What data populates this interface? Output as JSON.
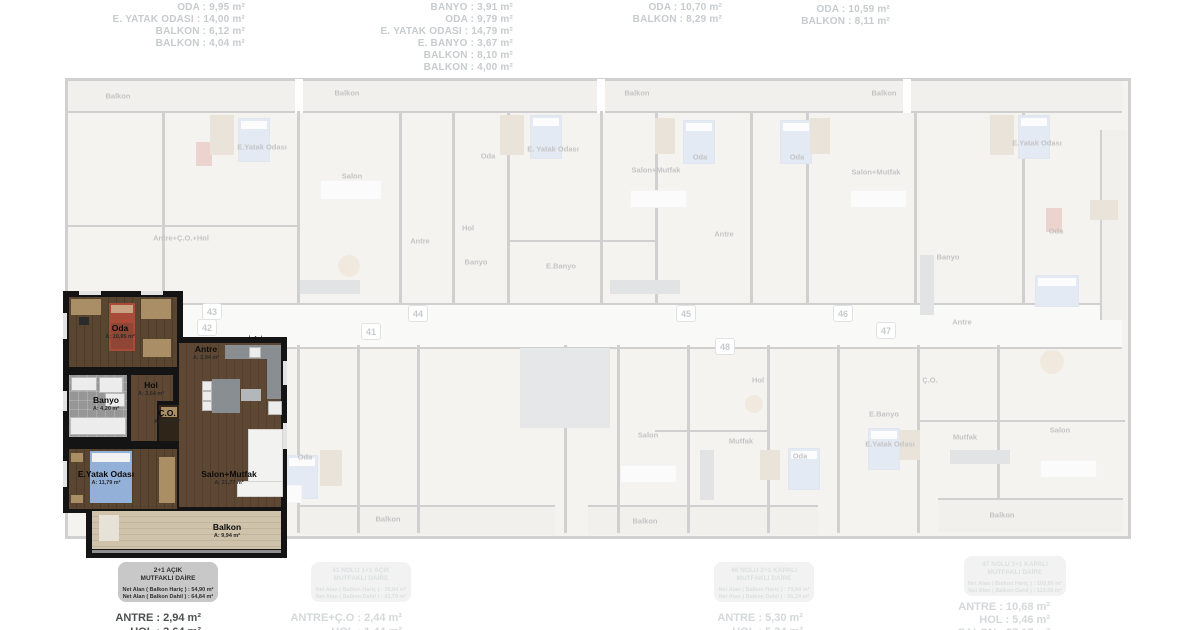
{
  "colors": {
    "highlight_wall": "#141414",
    "faded_gray": "#d1d1d1",
    "label_gray": "#c7cbce",
    "box_gray": "#c8c8c8"
  },
  "top_lines": [
    {
      "text": "ODA : 9,95 m²",
      "x": -5,
      "y": 2
    },
    {
      "text": "E. YATAK ODASI : 14,00 m²",
      "x": -5,
      "y": 14
    },
    {
      "text": "BALKON : 6,12 m²",
      "x": -5,
      "y": 26
    },
    {
      "text": "BALKON : 4,04 m²",
      "x": -5,
      "y": 38
    },
    {
      "text": "BANYO : 3,91 m²",
      "x": 263,
      "y": 2
    },
    {
      "text": "ODA : 9,79 m²",
      "x": 263,
      "y": 14
    },
    {
      "text": "E. YATAK ODASI : 14,79 m²",
      "x": 263,
      "y": 26
    },
    {
      "text": "E. BANYO : 3,67 m²",
      "x": 263,
      "y": 38
    },
    {
      "text": "BALKON : 8,10 m²",
      "x": 263,
      "y": 50
    },
    {
      "text": "BALKON : 4,00 m²",
      "x": 263,
      "y": 62
    },
    {
      "text": "ODA : 10,70 m²",
      "x": 472,
      "y": 2
    },
    {
      "text": "BALKON : 8,29 m²",
      "x": 472,
      "y": 14
    },
    {
      "text": "ODA : 10,59 m²",
      "x": 640,
      "y": 4
    },
    {
      "text": "BALKON : 8,11 m²",
      "x": 640,
      "y": 16
    }
  ],
  "plates": [
    {
      "num": "43",
      "x": 202,
      "y": 303
    },
    {
      "num": "42",
      "x": 197,
      "y": 319
    },
    {
      "num": "44",
      "x": 408,
      "y": 305
    },
    {
      "num": "41",
      "x": 361,
      "y": 323
    },
    {
      "num": "45",
      "x": 676,
      "y": 305
    },
    {
      "num": "46",
      "x": 833,
      "y": 305
    },
    {
      "num": "48",
      "x": 715,
      "y": 338
    },
    {
      "num": "47",
      "x": 876,
      "y": 322
    }
  ],
  "unit": {
    "marker": "⊢◆⊣",
    "rooms": [
      {
        "name": "Oda",
        "area": "A: 10,95 m²",
        "x": 57,
        "y": 41
      },
      {
        "name": "Antre",
        "area": "A: 2,94 m²",
        "x": 143,
        "y": 62
      },
      {
        "name": "Hol",
        "area": "A: 3,64 m²",
        "x": 88,
        "y": 98
      },
      {
        "name": "Banyo",
        "area": "A: 4,20 m²",
        "x": 43,
        "y": 113
      },
      {
        "name": "Ç.O.",
        "area": "A: 3,61 m²",
        "x": 104,
        "y": 126
      },
      {
        "name": "Salon+Mutfak",
        "area": "A: 21,77 m²",
        "x": 166,
        "y": 187
      },
      {
        "name": "E.Yatak Odası",
        "area": "A: 11,79 m²",
        "x": 43,
        "y": 187
      },
      {
        "name": "Balkon",
        "area": "A: 9,94 m²",
        "x": 164,
        "y": 240
      }
    ]
  },
  "unit_infobox": {
    "title1": "2+1 AÇIK",
    "title2": "MUTFAKLI DAİRE",
    "net1": "Net Alan ( Balkon Hariç ) : 54,90 m²",
    "net2": "Net Alan ( Balkon Dahil ) : 64,84 m²"
  },
  "other_infoboxes": [
    {
      "title1": "41 NOLU 1+1 AÇIK",
      "title2": "MUTFAKLI DAİRE",
      "net1": "Net Alan ( Balkon Hariç ) : 35,84 m²",
      "net2": "Net Alan ( Balkon Dahil ) : 43,79 m²",
      "x": 311,
      "y": 562,
      "w": 100
    },
    {
      "title1": "46 NOLU 2+1 KAPALI",
      "title2": "MUTFAKLI DAİRE",
      "net1": "Net Alan ( Balkon Hariç ) : 79,94 m²",
      "net2": "Net Alan ( Balkon Dahil ) : 95,34 m²",
      "x": 714,
      "y": 562,
      "w": 100
    },
    {
      "title1": "47 NOLU 3+1 KAPALI",
      "title2": "MUTFAKLI DAİRE",
      "net1": "Net Alan ( Balkon Hariç ) : 103,80 m²",
      "net2": "Net Alan ( Balkon Dahil ) : 119,56 m²",
      "x": 964,
      "y": 556,
      "w": 102
    }
  ],
  "hl_bottom_lines": [
    {
      "text": "ANTRE : 2,94 m²",
      "x": 1,
      "y": 612
    },
    {
      "text": "HOL : 3,64 m²",
      "x": 1,
      "y": 626
    }
  ],
  "dim_bottom_lines": [
    {
      "text": "ANTRE+Ç.O : 2,44 m²",
      "x": 202,
      "y": 612
    },
    {
      "text": "HOL : 1,44 m²",
      "x": 202,
      "y": 626
    },
    {
      "text": "ANTRE : 5,30 m²",
      "x": 603,
      "y": 612
    },
    {
      "text": "HOL : 5,34 m²",
      "x": 603,
      "y": 626
    },
    {
      "text": "ANTRE : 10,68 m²",
      "x": 850,
      "y": 601
    },
    {
      "text": "HOL : 5,46 m²",
      "x": 850,
      "y": 614
    },
    {
      "text": "SALON : 27,17 m²",
      "x": 850,
      "y": 627
    }
  ],
  "faded_labels": [
    {
      "text": "Balkon",
      "x": 118,
      "y": 96
    },
    {
      "text": "Balkon",
      "x": 347,
      "y": 93
    },
    {
      "text": "Balkon",
      "x": 637,
      "y": 93
    },
    {
      "text": "Balkon",
      "x": 884,
      "y": 93
    },
    {
      "text": "E.Yatak Odası",
      "x": 262,
      "y": 147
    },
    {
      "text": "Oda",
      "x": 488,
      "y": 156
    },
    {
      "text": "E. Yatak Odası",
      "x": 553,
      "y": 149
    },
    {
      "text": "Oda",
      "x": 700,
      "y": 157
    },
    {
      "text": "Oda",
      "x": 797,
      "y": 157
    },
    {
      "text": "E.Yatak Odası",
      "x": 1037,
      "y": 143
    },
    {
      "text": "Salon+Mutfak",
      "x": 656,
      "y": 170
    },
    {
      "text": "Salon+Mutfak",
      "x": 876,
      "y": 172
    },
    {
      "text": "Salon",
      "x": 352,
      "y": 176
    },
    {
      "text": "Antre+Ç.O.+Hol",
      "x": 181,
      "y": 238
    },
    {
      "text": "Hol",
      "x": 468,
      "y": 228
    },
    {
      "text": "Antre",
      "x": 420,
      "y": 241
    },
    {
      "text": "Banyo",
      "x": 476,
      "y": 262
    },
    {
      "text": "E.Banyo",
      "x": 561,
      "y": 266
    },
    {
      "text": "Oda",
      "x": 1056,
      "y": 231
    },
    {
      "text": "Antre",
      "x": 724,
      "y": 234
    },
    {
      "text": "Banyo",
      "x": 948,
      "y": 257
    },
    {
      "text": "Antre",
      "x": 962,
      "y": 322
    },
    {
      "text": "Hol",
      "x": 758,
      "y": 380
    },
    {
      "text": "Ç.O.",
      "x": 930,
      "y": 380
    },
    {
      "text": "E.Banyo",
      "x": 884,
      "y": 414
    },
    {
      "text": "Oda",
      "x": 305,
      "y": 457
    },
    {
      "text": "Salon",
      "x": 648,
      "y": 435
    },
    {
      "text": "Mutfak",
      "x": 741,
      "y": 441
    },
    {
      "text": "Mutfak",
      "x": 965,
      "y": 437
    },
    {
      "text": "Oda",
      "x": 800,
      "y": 456
    },
    {
      "text": "E.Yatak Odası",
      "x": 890,
      "y": 444
    },
    {
      "text": "Salon",
      "x": 1060,
      "y": 430
    },
    {
      "text": "Balkon",
      "x": 388,
      "y": 519
    },
    {
      "text": "Balkon",
      "x": 645,
      "y": 521
    },
    {
      "text": "Balkon",
      "x": 1002,
      "y": 515
    }
  ]
}
